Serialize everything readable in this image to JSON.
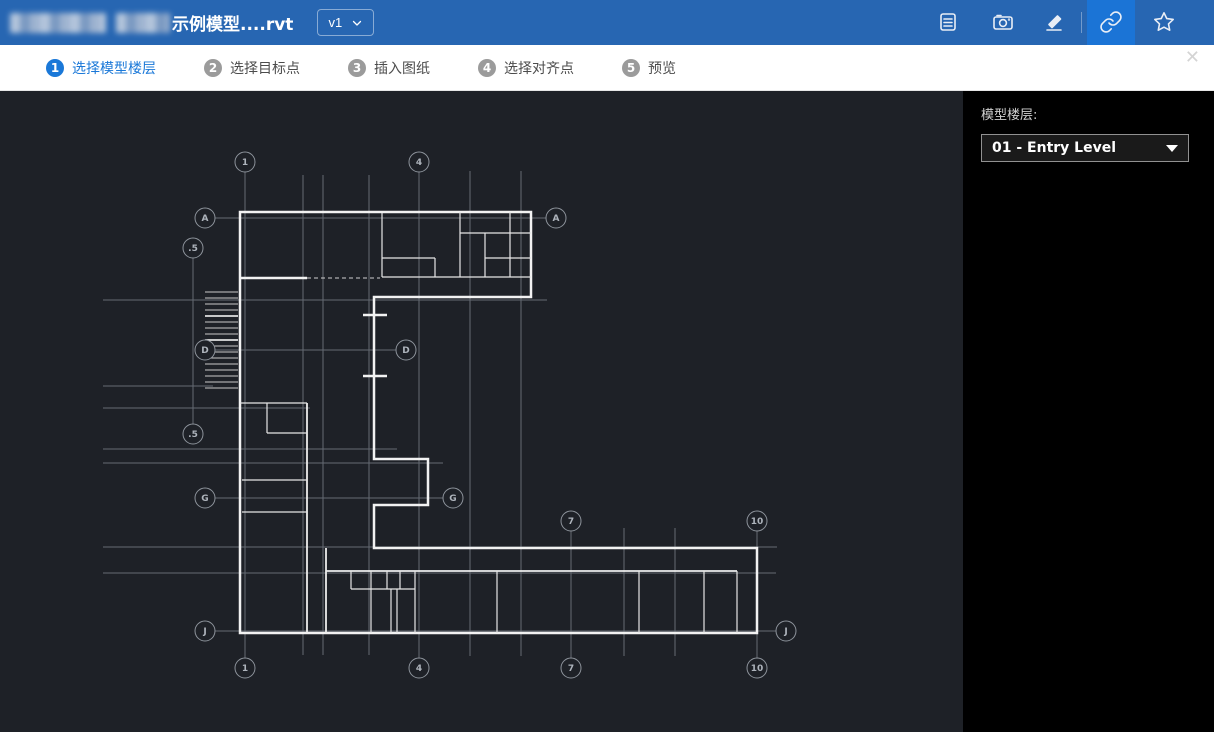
{
  "topbar": {
    "title": "示例模型....rvt",
    "title_redacted_prefix": true,
    "version_label": "v1",
    "icons": [
      "notes-icon",
      "camera-icon",
      "pen-icon",
      "link-icon",
      "star-icon"
    ],
    "active_icon": "link-icon"
  },
  "wizard": {
    "steps": [
      {
        "num": "1",
        "label": "选择模型楼层",
        "active": true
      },
      {
        "num": "2",
        "label": "选择目标点",
        "active": false
      },
      {
        "num": "3",
        "label": "插入图纸",
        "active": false
      },
      {
        "num": "4",
        "label": "选择对齐点",
        "active": false
      },
      {
        "num": "5",
        "label": "预览",
        "active": false
      }
    ],
    "close_glyph": "✕"
  },
  "panel": {
    "label": "模型楼层:",
    "dropdown_value": "01 - Entry Level"
  },
  "floorplan": {
    "grid_bubbles": [
      {
        "x": 245,
        "y": 162,
        "label": "1"
      },
      {
        "x": 419,
        "y": 162,
        "label": "4"
      },
      {
        "x": 205,
        "y": 218,
        "label": "A"
      },
      {
        "x": 556,
        "y": 218,
        "label": "A"
      },
      {
        "x": 193,
        "y": 248,
        "label": ".5"
      },
      {
        "x": 205,
        "y": 350,
        "label": "D"
      },
      {
        "x": 406,
        "y": 350,
        "label": "D"
      },
      {
        "x": 193,
        "y": 434,
        "label": ".5"
      },
      {
        "x": 205,
        "y": 498,
        "label": "G"
      },
      {
        "x": 453,
        "y": 498,
        "label": "G"
      },
      {
        "x": 571,
        "y": 521,
        "label": "7"
      },
      {
        "x": 757,
        "y": 521,
        "label": "10"
      },
      {
        "x": 205,
        "y": 631,
        "label": "J"
      },
      {
        "x": 786,
        "y": 631,
        "label": "J"
      },
      {
        "x": 245,
        "y": 668,
        "label": "1"
      },
      {
        "x": 419,
        "y": 668,
        "label": "4"
      },
      {
        "x": 571,
        "y": 668,
        "label": "7"
      },
      {
        "x": 757,
        "y": 668,
        "label": "10"
      }
    ],
    "stairs": {
      "x1": 207,
      "x2": 238,
      "y_start": 292,
      "y_end": 388,
      "step": 6
    }
  },
  "colors": {
    "topbar_bg": "#2766b2",
    "topbar_active_bg": "#1b74d6",
    "accent_blue": "#1a78d8",
    "canvas_bg": "#1e2127",
    "panel_bg": "#000000",
    "wall_white": "#f2f2f2",
    "grid_gray": "#656b73",
    "step_inactive": "#9b9b9b"
  }
}
